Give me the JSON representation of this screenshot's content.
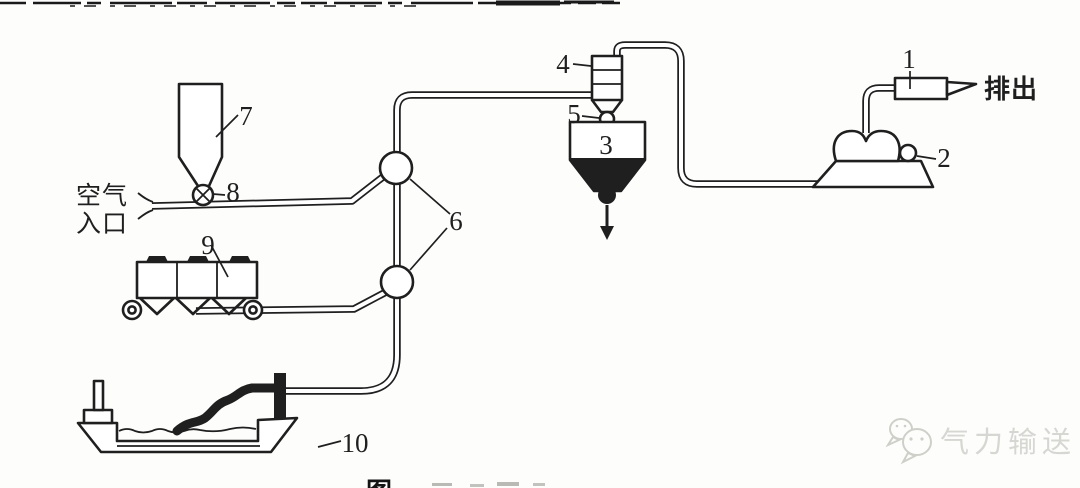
{
  "figure": {
    "callouts": {
      "c1": "1",
      "c2": "2",
      "c3": "3",
      "c4": "4",
      "c5": "5",
      "c6": "6",
      "c7": "7",
      "c8": "8",
      "c9": "9",
      "c10": "10"
    },
    "air_inlet": {
      "line1": "空气",
      "line2": "入口"
    },
    "discharge_label": "排出",
    "watermark_text": "气力输送",
    "caption_fragment": "图"
  },
  "colors": {
    "ink": "#1f1f1f",
    "wm": "#d6d6d2"
  }
}
